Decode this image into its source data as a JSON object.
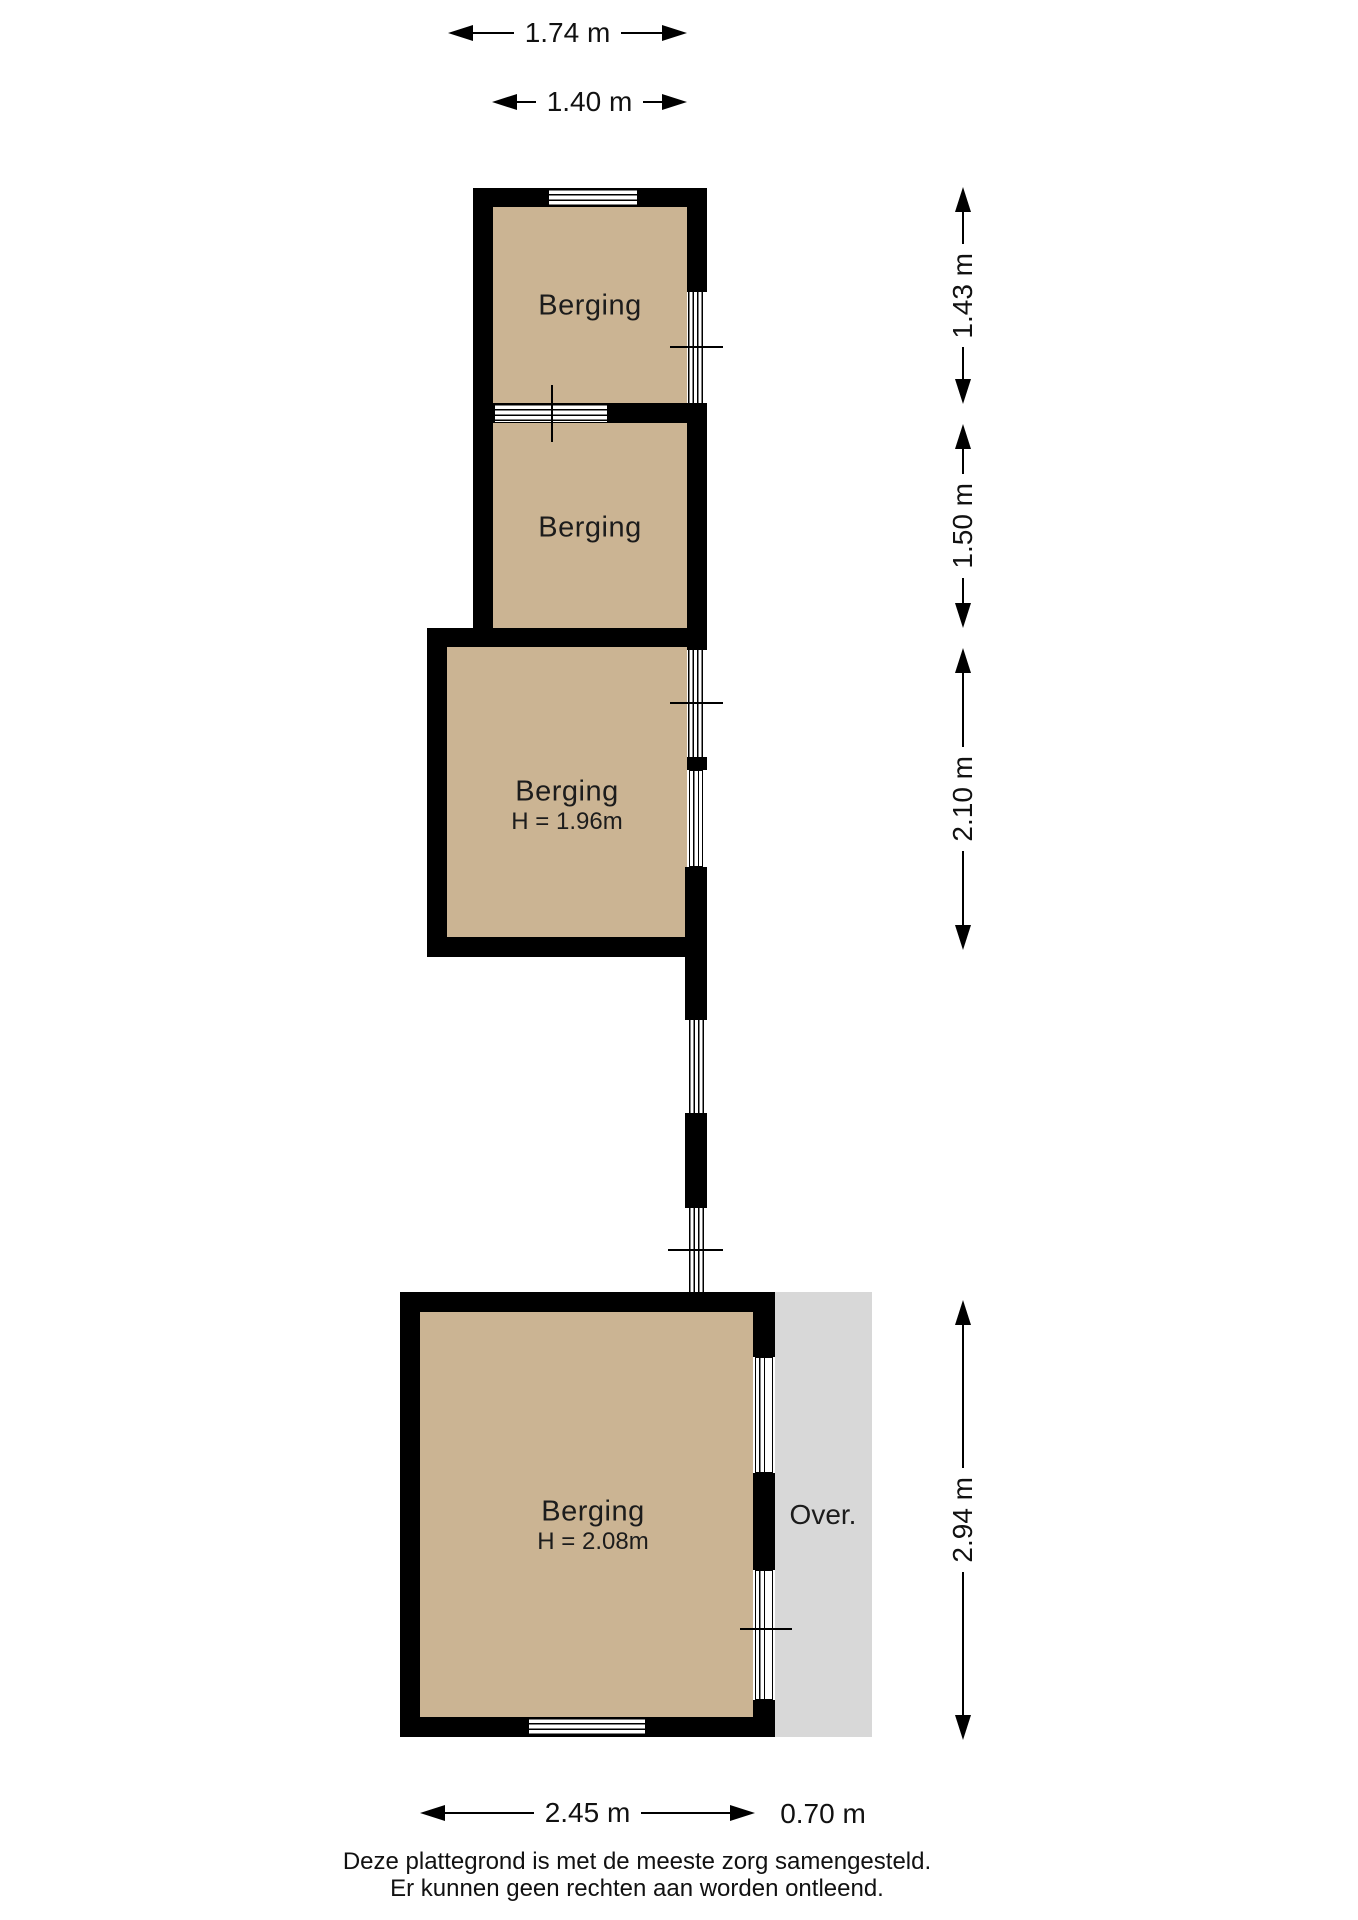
{
  "plan": {
    "rooms": [
      {
        "id": "berging-1",
        "label": "Berging"
      },
      {
        "id": "berging-2",
        "label": "Berging"
      },
      {
        "id": "berging-3",
        "label": "Berging",
        "height": "H = 1.96m"
      },
      {
        "id": "berging-4",
        "label": "Berging",
        "height": "H = 2.08m"
      }
    ],
    "overhang": {
      "label": "Over."
    }
  },
  "dimensions": {
    "top": [
      "1.74 m",
      "1.40 m"
    ],
    "right": [
      "1.43 m",
      "1.50 m",
      "2.10 m",
      "2.94 m"
    ],
    "bottom": [
      "2.45 m",
      "0.70 m"
    ]
  },
  "footer": {
    "line1": "Deze plattegrond is met de meeste zorg samengesteld.",
    "line2": "Er kunnen geen rechten aan worden ontleend."
  },
  "colors": {
    "room_fill": "#cbb493",
    "overhang_fill": "#d8d8d8",
    "wall": "#000000"
  }
}
